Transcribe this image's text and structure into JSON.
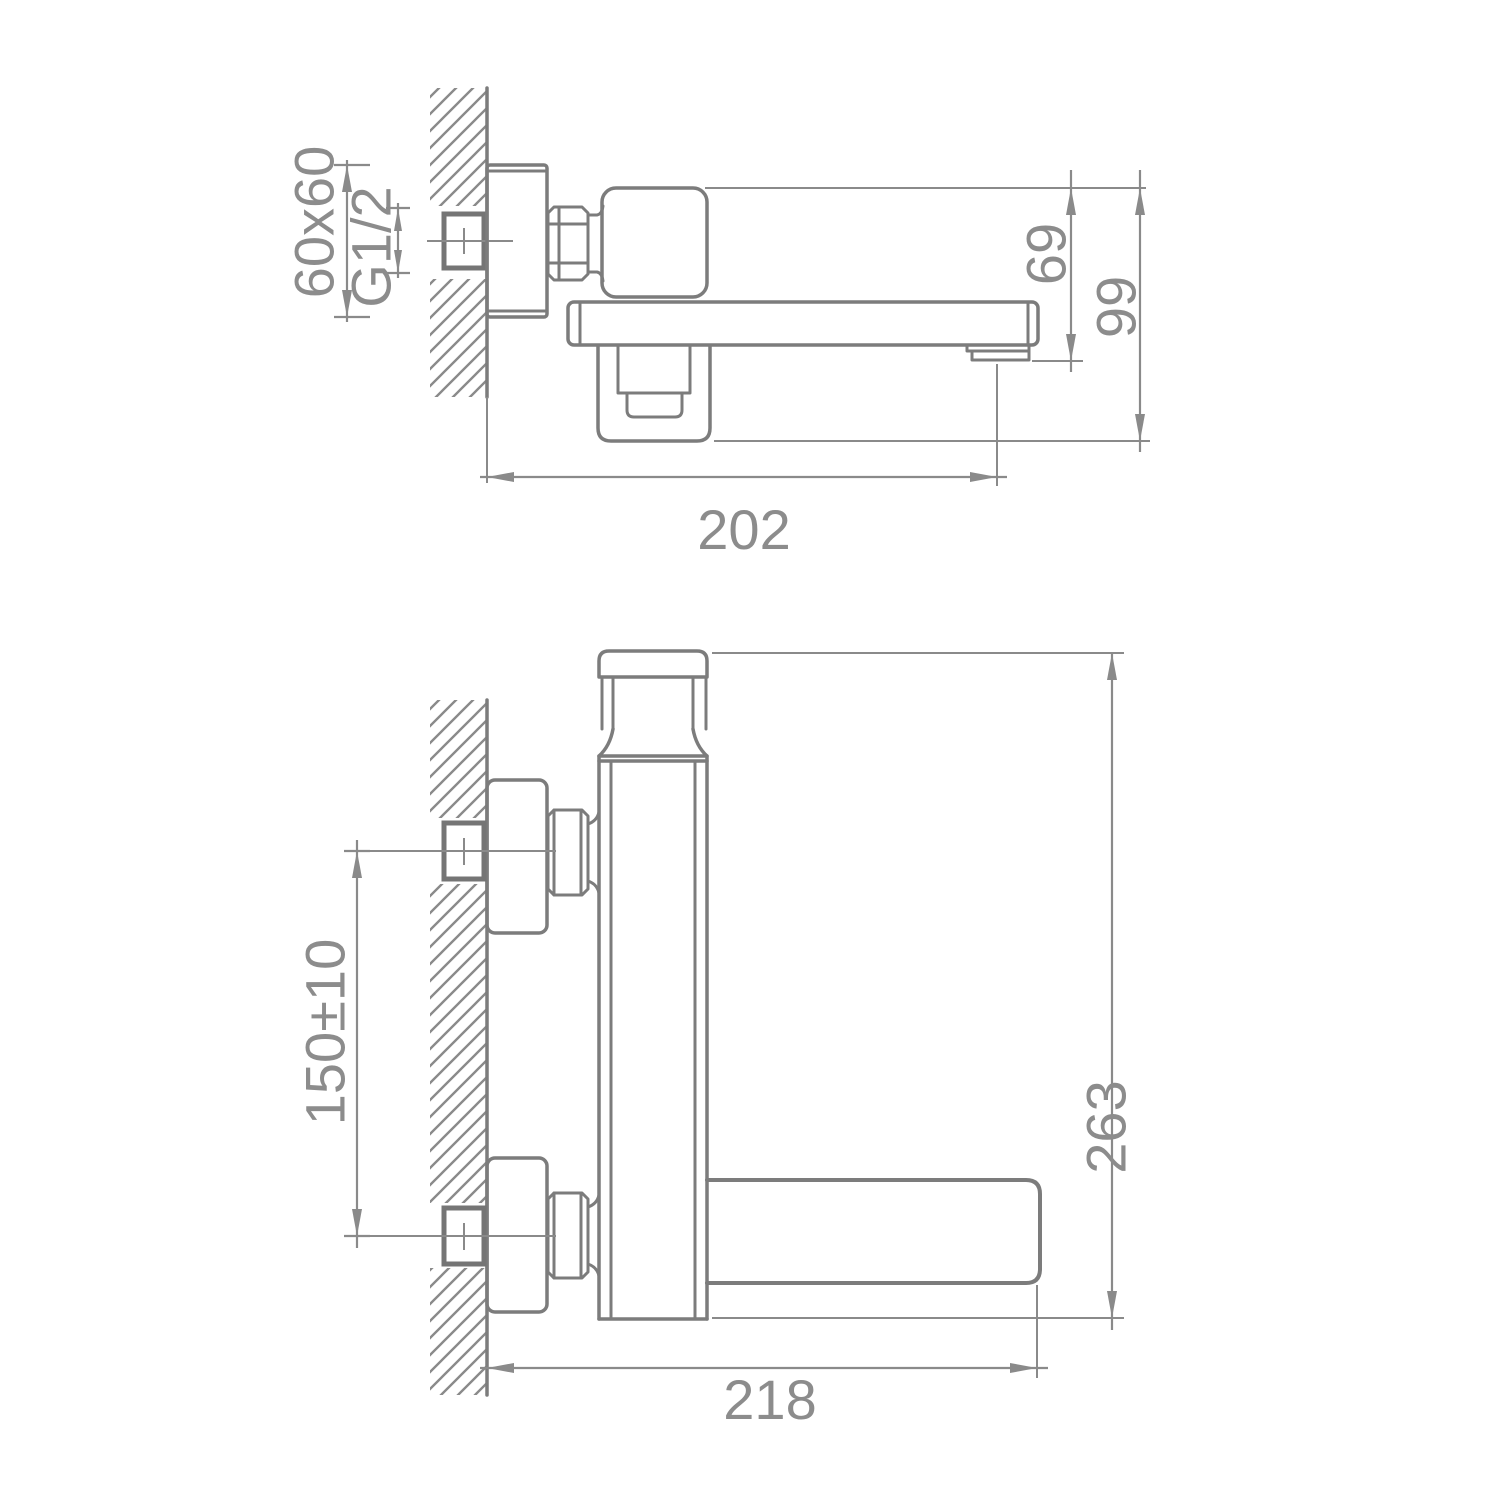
{
  "drawing": {
    "type": "technical-installation-drawing",
    "subject": "wall-mounted single-lever bath faucet with flat spout",
    "background_color": "#ffffff",
    "line_color": "#7c7c7c",
    "dim_color": "#8a8a8a",
    "views": {
      "top_view": {
        "name": "side view (spout profile)",
        "dimensions": {
          "flange_size": "60x60",
          "thread": "G1/2",
          "spout_drop": "69",
          "overall_depth": "99",
          "reach": "202"
        }
      },
      "front_view": {
        "name": "front view (mounting)",
        "dimensions": {
          "mount_spacing": "150±10",
          "overall_height": "263",
          "overall_length": "218"
        }
      }
    }
  }
}
